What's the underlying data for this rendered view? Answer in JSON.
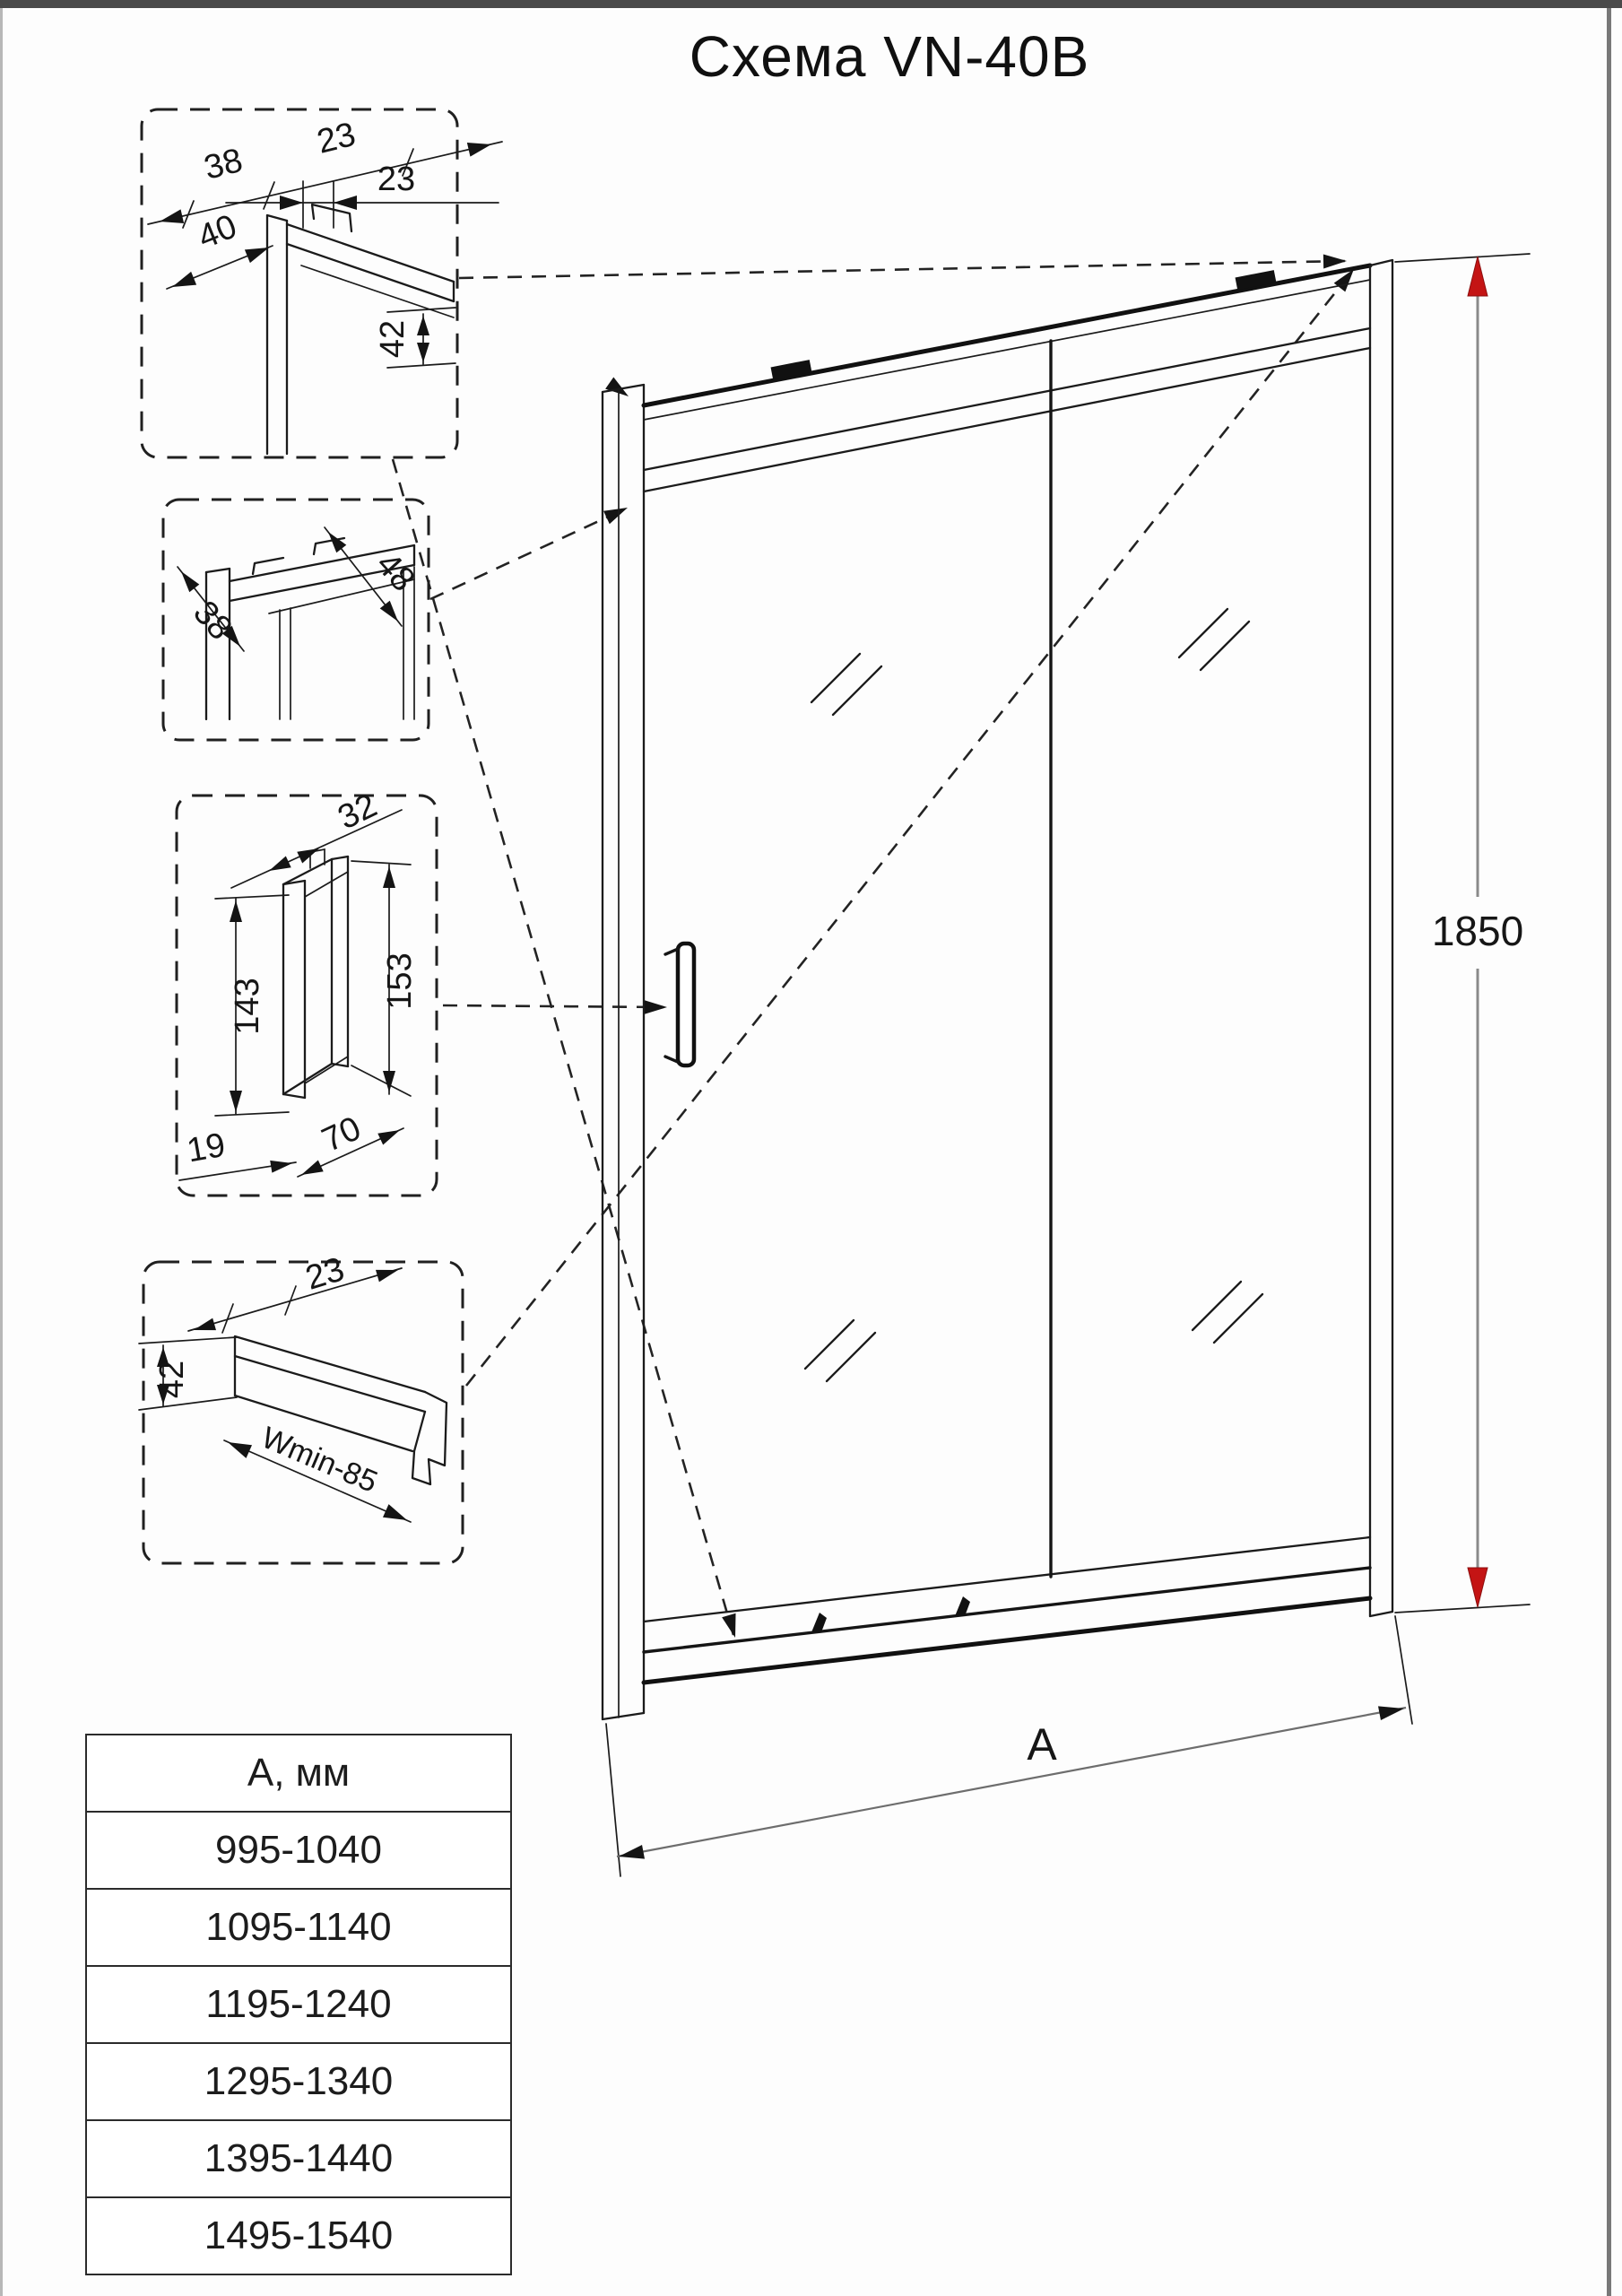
{
  "title": "Схема VN-40B",
  "details": {
    "box1": {
      "dim_38": "38",
      "dim_23_diag": "23",
      "dim_23_horiz": "23",
      "dim_40": "40",
      "dim_42": "42"
    },
    "box2": {
      "dim_48": "48",
      "dim_38": "38"
    },
    "box3": {
      "dim_32": "32",
      "dim_153": "153",
      "dim_143": "143",
      "dim_19": "19",
      "dim_70": "70"
    },
    "box4": {
      "dim_23": "23",
      "dim_42": "42",
      "dim_wmin": "Wmin-85"
    }
  },
  "dimensions": {
    "height": "1850",
    "width_label": "A"
  },
  "table": {
    "header": "А, мм",
    "rows": [
      "995-1040",
      "1095-1140",
      "1195-1240",
      "1295-1340",
      "1395-1440",
      "1495-1540"
    ]
  },
  "colors": {
    "accent_red": "#c41414",
    "line": "#1b1b1b"
  }
}
